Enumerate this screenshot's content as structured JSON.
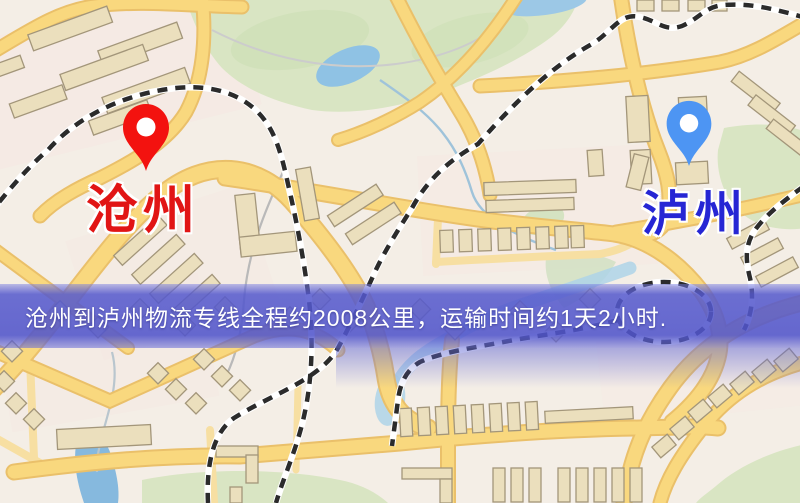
{
  "banner": {
    "text": "沧州到泸州物流专线全程约2008公里，运输时间约1天2小时.",
    "background": "#5559cd",
    "text_color": "#ffffff",
    "distance_km": "2008",
    "duration": "1天2小时"
  },
  "map": {
    "origin": {
      "label": "沧州",
      "pin_icon": "red-location-pin",
      "pin_color": "#f3120f",
      "label_color": "#e11515"
    },
    "destination": {
      "label": "泸州",
      "pin_icon": "blue-location-pin",
      "pin_color": "#4d95f3",
      "label_color": "#2626d4"
    },
    "theme": {
      "background": "#f4eee6",
      "residential_tint": "#f6e7e2",
      "road_fill": "#f9d87e",
      "road_casing": "#eac06a",
      "minor_road": "#f7dfa2",
      "building_fill": "#ebdfbd",
      "building_outline": "#a3967a",
      "park_green": "#d9e5c3",
      "water_blue": "#8fc2e4",
      "railway_black": "#2b2b2b"
    }
  }
}
